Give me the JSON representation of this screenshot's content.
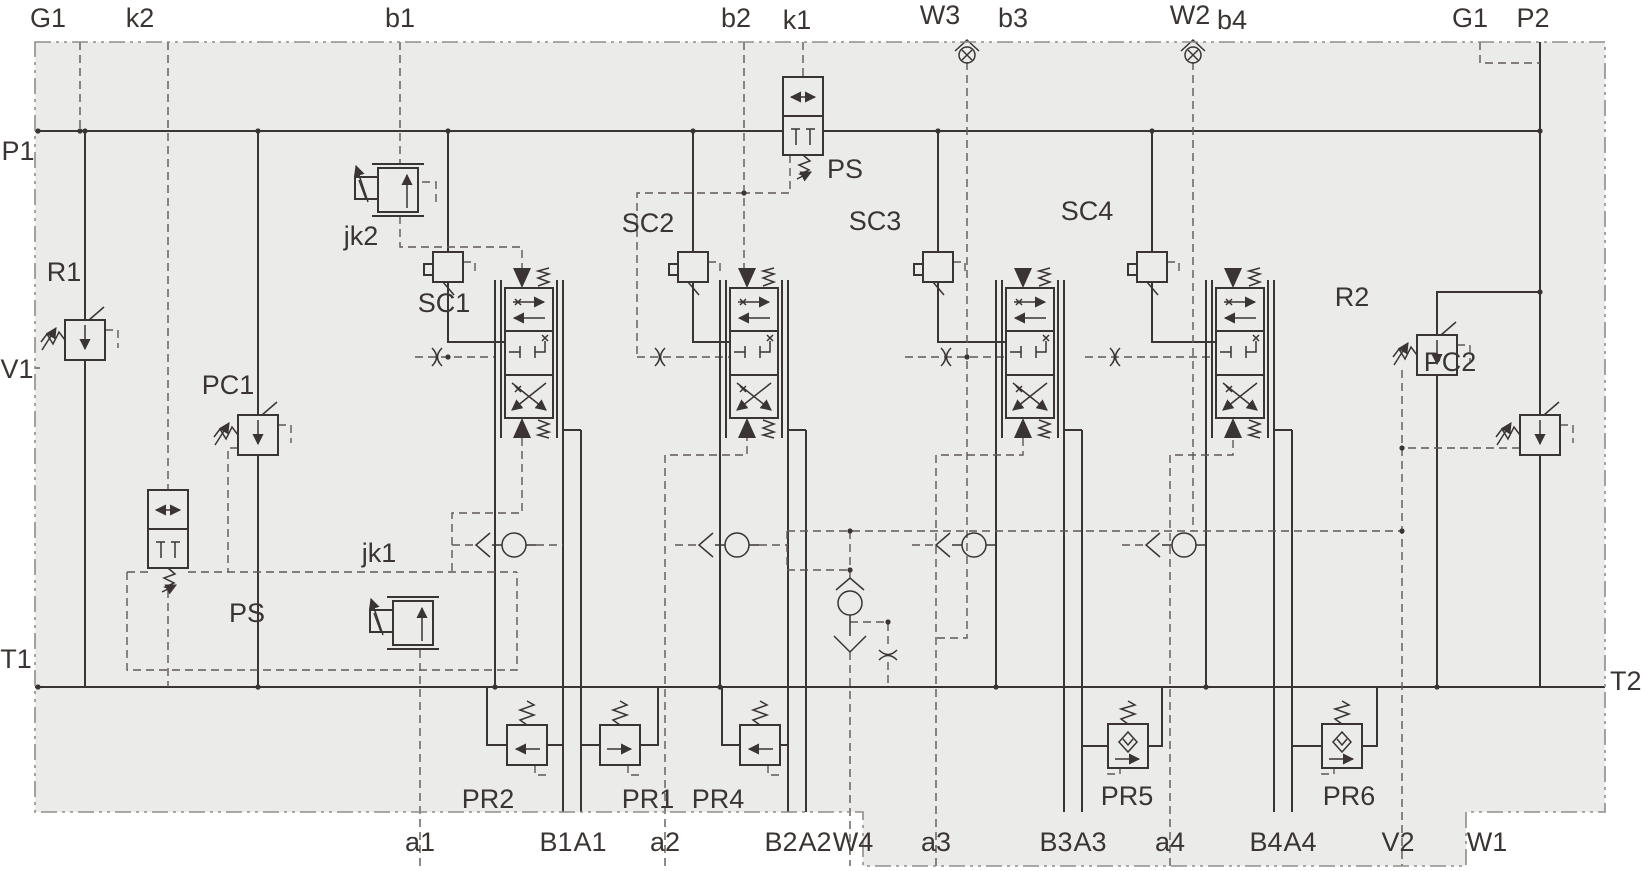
{
  "meta": {
    "diagram_type": "hydraulic manifold block schematic",
    "sections": 4,
    "colors": {
      "body_fill": "#ebebea",
      "line": "#3a3432",
      "dashed_line": "#5f5955",
      "border": "#8f8d89",
      "background": "#ffffff",
      "label_text": "#3a3532"
    }
  },
  "ports": {
    "top": [
      {
        "id": "G1"
      },
      {
        "id": "k2"
      },
      {
        "id": "b1"
      },
      {
        "id": "b2"
      },
      {
        "id": "k1"
      },
      {
        "id": "W3"
      },
      {
        "id": "b3"
      },
      {
        "id": "W2"
      },
      {
        "id": "b4"
      },
      {
        "id": "G1"
      },
      {
        "id": "P2"
      }
    ],
    "left": [
      {
        "id": "P1"
      },
      {
        "id": "V1"
      },
      {
        "id": "T1"
      }
    ],
    "right": [
      {
        "id": "T2"
      }
    ],
    "bottom": [
      {
        "id": "a1"
      },
      {
        "id": "B1"
      },
      {
        "id": "A1"
      },
      {
        "id": "a2"
      },
      {
        "id": "B2"
      },
      {
        "id": "A2"
      },
      {
        "id": "W4"
      },
      {
        "id": "a3"
      },
      {
        "id": "B3"
      },
      {
        "id": "A3"
      },
      {
        "id": "a4"
      },
      {
        "id": "B4"
      },
      {
        "id": "A4"
      },
      {
        "id": "V2"
      },
      {
        "id": "W1"
      }
    ]
  },
  "components": {
    "r1": "R1",
    "pc1": "PC1",
    "r2": "R2",
    "pc2": "PC2",
    "ps_top": "PS",
    "ps_bottom": "PS",
    "jk1": "jk1",
    "jk2": "jk2",
    "sc1": "SC1",
    "sc2": "SC2",
    "sc3": "SC3",
    "sc4": "SC4",
    "pr1": "PR1",
    "pr2": "PR2",
    "pr4": "PR4",
    "pr5": "PR5",
    "pr6": "PR6"
  }
}
